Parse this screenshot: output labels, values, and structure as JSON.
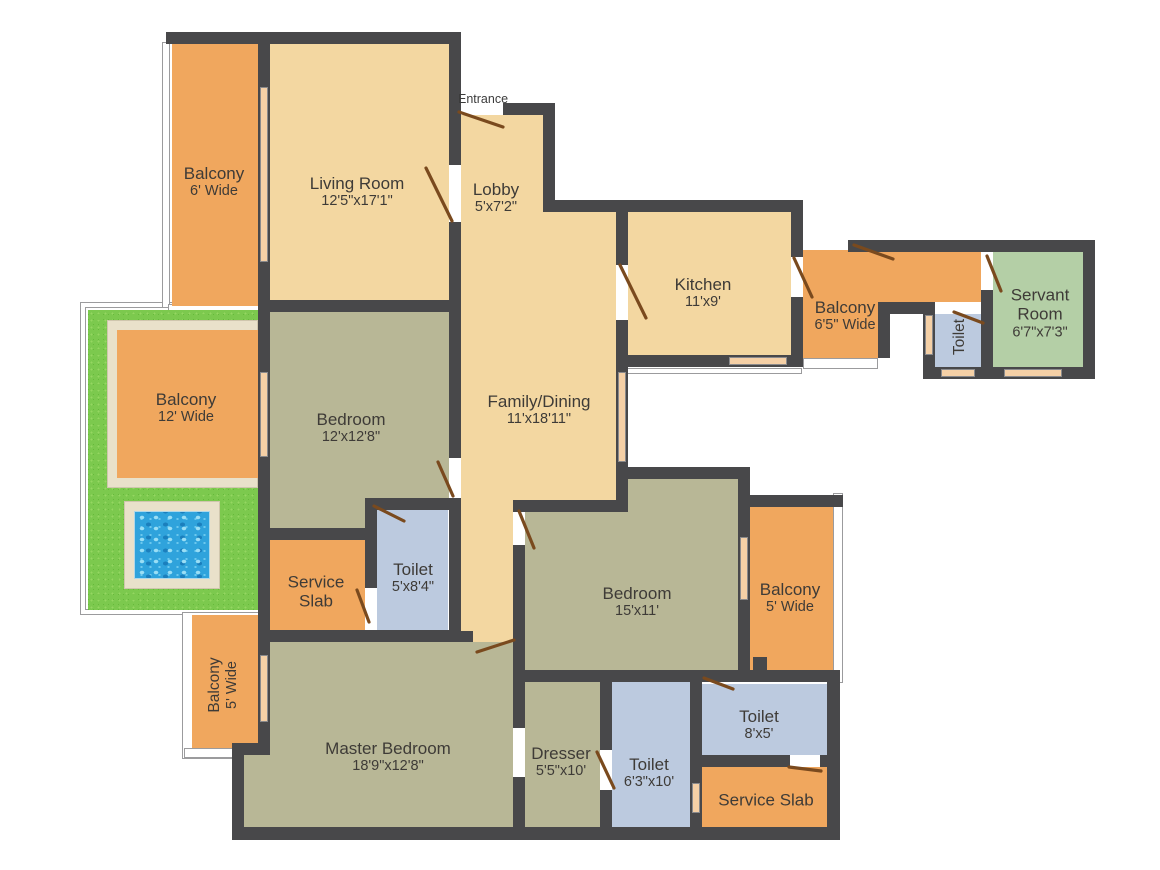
{
  "title": "Apartment Floor Plan",
  "canvas": {
    "w": 1160,
    "h": 870
  },
  "palette": {
    "wall": "#48484a",
    "room_beige": "#f3d7a1",
    "balcony_orange": "#f0a75e",
    "bedroom_olive": "#b8b796",
    "toilet_blue": "#bccadf",
    "servant_green": "#b4cfa6",
    "grass_green": "#7cc94e",
    "path_beige": "#e9e1ca",
    "pool_blue": "#2fa3dc",
    "door_brown": "#7a4a1e",
    "window_peach": "#f5d0a6",
    "label_text": "#3e3b37"
  },
  "rooms": [
    {
      "id": "balcony-6",
      "cx": 214,
      "cy": 182,
      "rot": 0,
      "lines": [
        {
          "t": "Balcony",
          "k": "n"
        },
        {
          "t": "6' Wide",
          "k": "d"
        }
      ]
    },
    {
      "id": "living-room",
      "cx": 357,
      "cy": 192,
      "rot": 0,
      "lines": [
        {
          "t": "Living Room",
          "k": "n"
        },
        {
          "t": "12'5\"x17'1\"",
          "k": "d"
        }
      ]
    },
    {
      "id": "entrance",
      "cx": 483,
      "cy": 99,
      "rot": 0,
      "lines": [
        {
          "t": "Entrance",
          "k": "s"
        }
      ]
    },
    {
      "id": "lobby",
      "cx": 496,
      "cy": 198,
      "rot": 0,
      "lines": [
        {
          "t": "Lobby",
          "k": "n"
        },
        {
          "t": "5'x7'2\"",
          "k": "d"
        }
      ]
    },
    {
      "id": "kitchen",
      "cx": 703,
      "cy": 293,
      "rot": 0,
      "lines": [
        {
          "t": "Kitchen",
          "k": "n"
        },
        {
          "t": "11'x9'",
          "k": "d"
        }
      ]
    },
    {
      "id": "balcony-65",
      "cx": 845,
      "cy": 316,
      "rot": 0,
      "lines": [
        {
          "t": "Balcony",
          "k": "n"
        },
        {
          "t": "6'5\" Wide",
          "k": "d"
        }
      ]
    },
    {
      "id": "toilet-small",
      "cx": 960,
      "cy": 337,
      "rot": -90,
      "lines": [
        {
          "t": "Toilet",
          "k": "m"
        }
      ]
    },
    {
      "id": "servant-room",
      "cx": 1040,
      "cy": 313,
      "rot": 0,
      "lines": [
        {
          "t": "Servant",
          "k": "n"
        },
        {
          "t": "Room",
          "k": "n"
        },
        {
          "t": "6'7\"x7'3\"",
          "k": "d"
        }
      ]
    },
    {
      "id": "balcony-12",
      "cx": 186,
      "cy": 408,
      "rot": 0,
      "lines": [
        {
          "t": "Balcony",
          "k": "n"
        },
        {
          "t": "12' Wide",
          "k": "d"
        }
      ]
    },
    {
      "id": "bedroom-12",
      "cx": 351,
      "cy": 428,
      "rot": 0,
      "lines": [
        {
          "t": "Bedroom",
          "k": "n"
        },
        {
          "t": "12'x12'8\"",
          "k": "d"
        }
      ]
    },
    {
      "id": "family-dining",
      "cx": 539,
      "cy": 410,
      "rot": 0,
      "lines": [
        {
          "t": "Family/Dining",
          "k": "n"
        },
        {
          "t": "11'x18'11\"",
          "k": "d"
        }
      ]
    },
    {
      "id": "service-slab-a",
      "cx": 316,
      "cy": 592,
      "rot": 0,
      "lines": [
        {
          "t": "Service",
          "k": "n"
        },
        {
          "t": "Slab",
          "k": "n"
        }
      ]
    },
    {
      "id": "toilet-a",
      "cx": 413,
      "cy": 578,
      "rot": 0,
      "lines": [
        {
          "t": "Toilet",
          "k": "n"
        },
        {
          "t": "5'x8'4\"",
          "k": "d"
        }
      ]
    },
    {
      "id": "bedroom-15",
      "cx": 637,
      "cy": 602,
      "rot": 0,
      "lines": [
        {
          "t": "Bedroom",
          "k": "n"
        },
        {
          "t": "15'x11'",
          "k": "d"
        }
      ]
    },
    {
      "id": "balcony-5r",
      "cx": 790,
      "cy": 598,
      "rot": 0,
      "lines": [
        {
          "t": "Balcony",
          "k": "n"
        },
        {
          "t": "5' Wide",
          "k": "d"
        }
      ]
    },
    {
      "id": "balcony-5l",
      "cx": 223,
      "cy": 685,
      "rot": -90,
      "lines": [
        {
          "t": "Balcony",
          "k": "m"
        },
        {
          "t": "5' Wide",
          "k": "d"
        }
      ]
    },
    {
      "id": "master-bedroom",
      "cx": 388,
      "cy": 757,
      "rot": 0,
      "lines": [
        {
          "t": "Master Bedroom",
          "k": "n"
        },
        {
          "t": "18'9\"x12'8\"",
          "k": "d"
        }
      ]
    },
    {
      "id": "dresser",
      "cx": 561,
      "cy": 762,
      "rot": 0,
      "lines": [
        {
          "t": "Dresser",
          "k": "n"
        },
        {
          "t": "5'5\"x10'",
          "k": "d"
        }
      ]
    },
    {
      "id": "toilet-63",
      "cx": 649,
      "cy": 773,
      "rot": 0,
      "lines": [
        {
          "t": "Toilet",
          "k": "n"
        },
        {
          "t": "6'3\"x10'",
          "k": "d"
        }
      ]
    },
    {
      "id": "toilet-8",
      "cx": 759,
      "cy": 725,
      "rot": 0,
      "lines": [
        {
          "t": "Toilet",
          "k": "n"
        },
        {
          "t": "8'x5'",
          "k": "d"
        }
      ]
    },
    {
      "id": "service-slab-b",
      "cx": 766,
      "cy": 800,
      "rot": 0,
      "lines": [
        {
          "t": "Service Slab",
          "k": "n"
        }
      ]
    }
  ],
  "frames": [
    {
      "x": 80,
      "y": 302,
      "w": 215,
      "h": 313
    },
    {
      "x": 85,
      "y": 307,
      "w": 205,
      "h": 303,
      "inner": true
    },
    {
      "x": 182,
      "y": 612,
      "w": 78,
      "h": 147
    },
    {
      "x": 162,
      "y": 42,
      "w": 8,
      "h": 266
    },
    {
      "x": 168,
      "y": 304,
      "w": 92,
      "h": 12
    },
    {
      "x": 833,
      "y": 493,
      "w": 10,
      "h": 190
    },
    {
      "x": 803,
      "y": 358,
      "w": 75,
      "h": 11
    },
    {
      "x": 184,
      "y": 748,
      "w": 74,
      "h": 10
    },
    {
      "x": 616,
      "y": 368,
      "w": 186,
      "h": 6
    }
  ],
  "fills": [
    {
      "id": "grass",
      "x": 88,
      "y": 310,
      "w": 170,
      "h": 300,
      "c": "grass"
    },
    {
      "id": "path-ring",
      "x": 107,
      "y": 320,
      "w": 151,
      "h": 168,
      "c": "path"
    },
    {
      "id": "balcony-12",
      "x": 117,
      "y": 330,
      "w": 141,
      "h": 148,
      "c": "orange"
    },
    {
      "id": "pool-frame",
      "x": 124,
      "y": 501,
      "w": 96,
      "h": 88,
      "c": "path"
    },
    {
      "id": "pool-water",
      "x": 134,
      "y": 511,
      "w": 76,
      "h": 68,
      "c": "pool"
    },
    {
      "id": "balcony-6",
      "x": 172,
      "y": 44,
      "w": 86,
      "h": 262,
      "c": "orange"
    },
    {
      "id": "living-room",
      "x": 270,
      "y": 44,
      "w": 179,
      "h": 256,
      "c": "beige"
    },
    {
      "id": "lobby",
      "x": 461,
      "y": 115,
      "w": 82,
      "h": 97,
      "c": "beige"
    },
    {
      "id": "family-main",
      "x": 461,
      "y": 212,
      "w": 155,
      "h": 288,
      "c": "beige"
    },
    {
      "id": "family-low",
      "x": 461,
      "y": 500,
      "w": 52,
      "h": 142,
      "c": "beige"
    },
    {
      "id": "kitchen",
      "x": 628,
      "y": 212,
      "w": 163,
      "h": 143,
      "c": "beige"
    },
    {
      "id": "balcony-65",
      "x": 803,
      "y": 250,
      "w": 75,
      "h": 108,
      "c": "orange"
    },
    {
      "id": "corridor",
      "x": 878,
      "y": 252,
      "w": 103,
      "h": 50,
      "c": "orange"
    },
    {
      "id": "toilet-small",
      "x": 935,
      "y": 314,
      "w": 46,
      "h": 53,
      "c": "blue"
    },
    {
      "id": "servant-room",
      "x": 993,
      "y": 252,
      "w": 90,
      "h": 115,
      "c": "green"
    },
    {
      "id": "bedroom-12-a",
      "x": 270,
      "y": 312,
      "w": 179,
      "h": 186,
      "c": "olive"
    },
    {
      "id": "bedroom-12-b",
      "x": 270,
      "y": 498,
      "w": 95,
      "h": 30,
      "c": "olive"
    },
    {
      "id": "toilet-a",
      "x": 377,
      "y": 510,
      "w": 71,
      "h": 120,
      "c": "blue"
    },
    {
      "id": "service-slab-a",
      "x": 270,
      "y": 540,
      "w": 95,
      "h": 90,
      "c": "orange"
    },
    {
      "id": "bedroom-15-n",
      "x": 628,
      "y": 479,
      "w": 110,
      "h": 33,
      "c": "olive"
    },
    {
      "id": "bedroom-15",
      "x": 525,
      "y": 512,
      "w": 213,
      "h": 158,
      "c": "olive"
    },
    {
      "id": "balcony-5r",
      "x": 750,
      "y": 507,
      "w": 83,
      "h": 163,
      "c": "orange"
    },
    {
      "id": "balcony-5l",
      "x": 192,
      "y": 615,
      "w": 66,
      "h": 133,
      "c": "orange"
    },
    {
      "id": "master-main",
      "x": 270,
      "y": 642,
      "w": 243,
      "h": 185,
      "c": "olive"
    },
    {
      "id": "master-step",
      "x": 244,
      "y": 755,
      "w": 26,
      "h": 72,
      "c": "olive"
    },
    {
      "id": "dresser",
      "x": 525,
      "y": 682,
      "w": 75,
      "h": 145,
      "c": "olive"
    },
    {
      "id": "toilet-63",
      "x": 612,
      "y": 682,
      "w": 78,
      "h": 145,
      "c": "blue"
    },
    {
      "id": "toilet-8",
      "x": 702,
      "y": 684,
      "w": 125,
      "h": 71,
      "c": "blue"
    },
    {
      "id": "service-slab-b",
      "x": 702,
      "y": 767,
      "w": 125,
      "h": 60,
      "c": "orange"
    }
  ],
  "walls": [
    {
      "x": 166,
      "y": 32,
      "w": 295,
      "h": 12
    },
    {
      "x": 503,
      "y": 103,
      "w": 52,
      "h": 12
    },
    {
      "x": 543,
      "y": 103,
      "w": 12,
      "h": 109
    },
    {
      "x": 543,
      "y": 200,
      "w": 260,
      "h": 12
    },
    {
      "x": 616,
      "y": 205,
      "w": 12,
      "h": 60
    },
    {
      "x": 616,
      "y": 320,
      "w": 12,
      "h": 47
    },
    {
      "x": 616,
      "y": 367,
      "w": 12,
      "h": 100
    },
    {
      "x": 791,
      "y": 200,
      "w": 12,
      "h": 57
    },
    {
      "x": 791,
      "y": 297,
      "w": 12,
      "h": 70
    },
    {
      "x": 616,
      "y": 355,
      "w": 187,
      "h": 12
    },
    {
      "x": 848,
      "y": 240,
      "w": 247,
      "h": 12
    },
    {
      "x": 1083,
      "y": 240,
      "w": 12,
      "h": 139
    },
    {
      "x": 981,
      "y": 290,
      "w": 12,
      "h": 77
    },
    {
      "x": 878,
      "y": 302,
      "w": 57,
      "h": 12
    },
    {
      "x": 878,
      "y": 302,
      "w": 12,
      "h": 56
    },
    {
      "x": 923,
      "y": 302,
      "w": 12,
      "h": 65
    },
    {
      "x": 923,
      "y": 367,
      "w": 70,
      "h": 12
    },
    {
      "x": 981,
      "y": 367,
      "w": 114,
      "h": 12
    },
    {
      "x": 258,
      "y": 32,
      "w": 12,
      "h": 280
    },
    {
      "x": 449,
      "y": 32,
      "w": 12,
      "h": 133
    },
    {
      "x": 449,
      "y": 222,
      "w": 12,
      "h": 90
    },
    {
      "x": 258,
      "y": 300,
      "w": 203,
      "h": 12
    },
    {
      "x": 449,
      "y": 312,
      "w": 12,
      "h": 146
    },
    {
      "x": 449,
      "y": 505,
      "w": 12,
      "h": 137
    },
    {
      "x": 258,
      "y": 312,
      "w": 12,
      "h": 318
    },
    {
      "x": 258,
      "y": 630,
      "w": 203,
      "h": 12
    },
    {
      "x": 449,
      "y": 631,
      "w": 24,
      "h": 11
    },
    {
      "x": 258,
      "y": 528,
      "w": 107,
      "h": 12
    },
    {
      "x": 365,
      "y": 498,
      "w": 96,
      "h": 12
    },
    {
      "x": 365,
      "y": 510,
      "w": 12,
      "h": 78
    },
    {
      "x": 616,
      "y": 467,
      "w": 130,
      "h": 12
    },
    {
      "x": 616,
      "y": 479,
      "w": 12,
      "h": 33
    },
    {
      "x": 513,
      "y": 500,
      "w": 115,
      "h": 12
    },
    {
      "x": 513,
      "y": 545,
      "w": 12,
      "h": 183
    },
    {
      "x": 513,
      "y": 777,
      "w": 12,
      "h": 62
    },
    {
      "x": 738,
      "y": 467,
      "w": 12,
      "h": 215
    },
    {
      "x": 750,
      "y": 495,
      "w": 93,
      "h": 12
    },
    {
      "x": 513,
      "y": 670,
      "w": 327,
      "h": 12
    },
    {
      "x": 690,
      "y": 672,
      "w": 12,
      "h": 167
    },
    {
      "x": 600,
      "y": 682,
      "w": 12,
      "h": 68
    },
    {
      "x": 600,
      "y": 790,
      "w": 12,
      "h": 49
    },
    {
      "x": 690,
      "y": 755,
      "w": 100,
      "h": 12
    },
    {
      "x": 820,
      "y": 755,
      "w": 7,
      "h": 12
    },
    {
      "x": 827,
      "y": 672,
      "w": 13,
      "h": 167
    },
    {
      "x": 232,
      "y": 827,
      "w": 608,
      "h": 13
    },
    {
      "x": 258,
      "y": 642,
      "w": 12,
      "h": 101
    },
    {
      "x": 232,
      "y": 743,
      "w": 38,
      "h": 12
    },
    {
      "x": 232,
      "y": 743,
      "w": 12,
      "h": 97
    },
    {
      "x": 753,
      "y": 657,
      "w": 14,
      "h": 16
    }
  ],
  "windows": [
    {
      "x": 260,
      "y": 87,
      "w": 8,
      "h": 175
    },
    {
      "x": 260,
      "y": 372,
      "w": 8,
      "h": 85
    },
    {
      "x": 260,
      "y": 655,
      "w": 8,
      "h": 67
    },
    {
      "x": 618,
      "y": 372,
      "w": 8,
      "h": 90
    },
    {
      "x": 729,
      "y": 357,
      "w": 58,
      "h": 8
    },
    {
      "x": 925,
      "y": 315,
      "w": 8,
      "h": 40
    },
    {
      "x": 941,
      "y": 369,
      "w": 34,
      "h": 8
    },
    {
      "x": 1004,
      "y": 369,
      "w": 58,
      "h": 8
    },
    {
      "x": 740,
      "y": 537,
      "w": 8,
      "h": 63
    },
    {
      "x": 692,
      "y": 783,
      "w": 8,
      "h": 30
    }
  ],
  "doors": [
    {
      "x1": 459,
      "y1": 112,
      "x2": 503,
      "y2": 127
    },
    {
      "x1": 452,
      "y1": 221,
      "x2": 426,
      "y2": 168
    },
    {
      "x1": 620,
      "y1": 265,
      "x2": 646,
      "y2": 318
    },
    {
      "x1": 794,
      "y1": 258,
      "x2": 812,
      "y2": 297
    },
    {
      "x1": 854,
      "y1": 245,
      "x2": 893,
      "y2": 259
    },
    {
      "x1": 954,
      "y1": 312,
      "x2": 983,
      "y2": 323
    },
    {
      "x1": 987,
      "y1": 256,
      "x2": 1001,
      "y2": 291
    },
    {
      "x1": 438,
      "y1": 462,
      "x2": 453,
      "y2": 496
    },
    {
      "x1": 374,
      "y1": 506,
      "x2": 404,
      "y2": 521
    },
    {
      "x1": 357,
      "y1": 590,
      "x2": 369,
      "y2": 622
    },
    {
      "x1": 519,
      "y1": 511,
      "x2": 534,
      "y2": 548
    },
    {
      "x1": 477,
      "y1": 652,
      "x2": 514,
      "y2": 640
    },
    {
      "x1": 597,
      "y1": 752,
      "x2": 614,
      "y2": 788
    },
    {
      "x1": 704,
      "y1": 678,
      "x2": 733,
      "y2": 689
    },
    {
      "x1": 789,
      "y1": 767,
      "x2": 821,
      "y2": 771
    }
  ]
}
